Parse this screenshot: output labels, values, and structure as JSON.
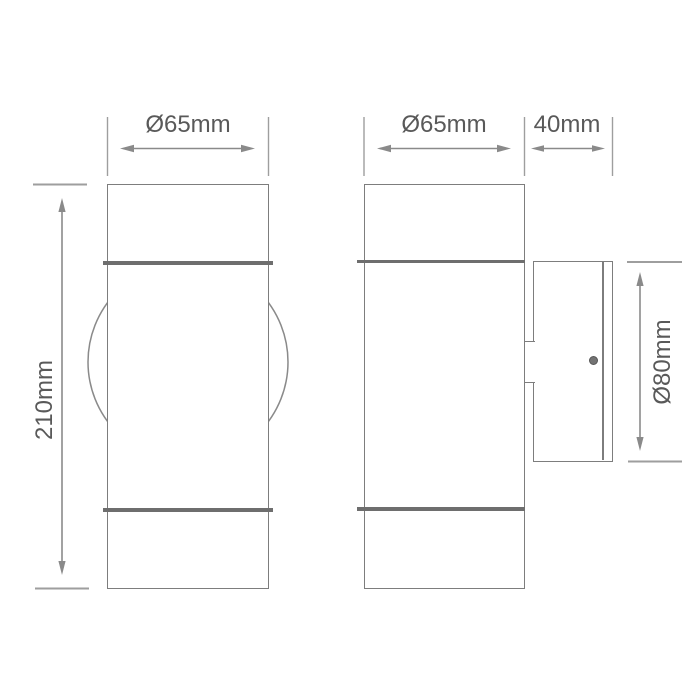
{
  "drawing": {
    "kind": "technical-dimension-drawing",
    "subject": "cylindrical up-down wall light, front and side views",
    "front_view": {
      "diameter_label": "Ø65mm",
      "height_label": "210mm"
    },
    "side_view": {
      "diameter_label": "Ø65mm",
      "depth_label": "40mm",
      "backplate_diameter_label": "Ø80mm"
    },
    "colors": {
      "background": "#ffffff",
      "outline": "#7d7d7d",
      "band": "#6e6e6e",
      "dimension_line": "#8a8a8a",
      "extension_line": "#9e9e9e",
      "label_text": "#595959"
    }
  }
}
